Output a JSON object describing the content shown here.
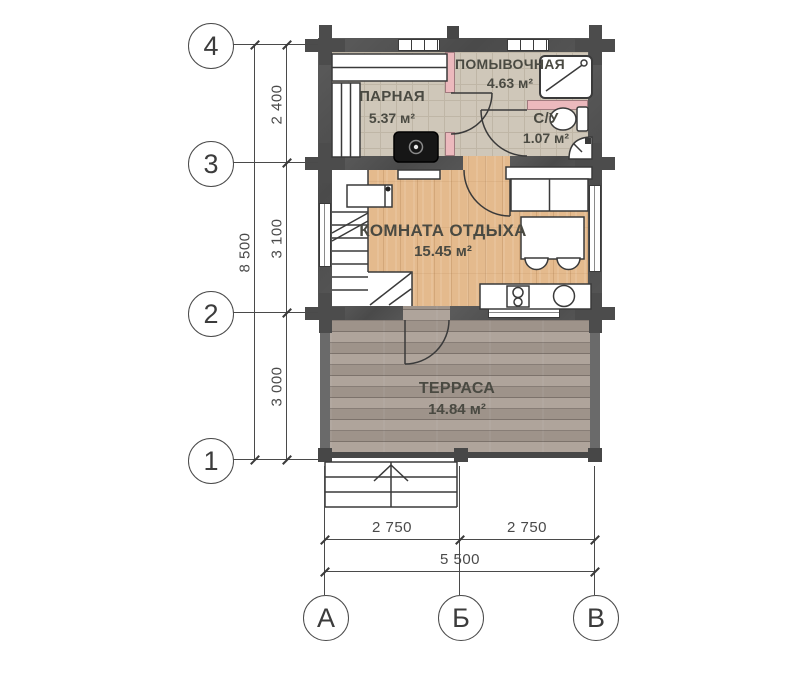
{
  "plan": {
    "title": "bathhouse-floor-plan",
    "rooms": [
      {
        "name": "ПАРНАЯ",
        "area": "5.37 м²"
      },
      {
        "name": "ПОМЫВОЧНАЯ",
        "area": "4.63 м²"
      },
      {
        "name": "С/У",
        "area": "1.07 м²"
      },
      {
        "name": "КОМНАТА ОТДЫХА",
        "area": "15.45 м²"
      },
      {
        "name": "ТЕРРАСА",
        "area": "14.84 м²"
      }
    ],
    "row_axes": [
      {
        "label": "4"
      },
      {
        "label": "3"
      },
      {
        "label": "2"
      },
      {
        "label": "1"
      }
    ],
    "col_axes": [
      {
        "label": "А"
      },
      {
        "label": "Б"
      },
      {
        "label": "В"
      }
    ],
    "dims": {
      "v_segments": [
        "2 400",
        "3 100",
        "3 000"
      ],
      "v_total": "8 500",
      "h_segments": [
        "2 750",
        "2 750"
      ],
      "h_total": "5 500"
    },
    "colors": {
      "wall": "#4f4f4f",
      "partition": "#ecb9bd",
      "tile_floor": "#cfc7b9",
      "wood_floor": "#e4ba8d",
      "terrace_floor": "#a89c93",
      "line": "#3a3a3a"
    }
  }
}
